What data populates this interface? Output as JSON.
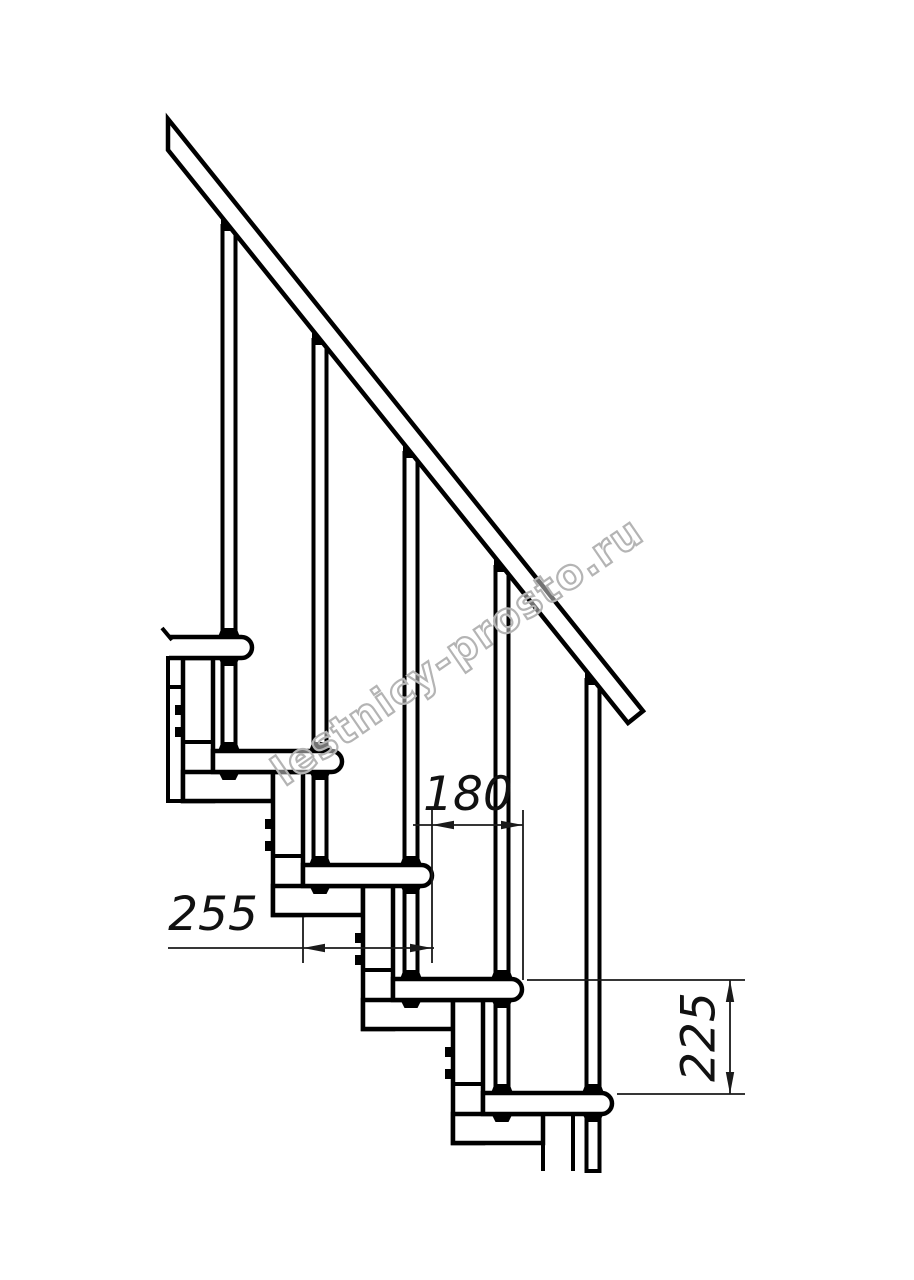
{
  "watermark": {
    "text": "lestnicy-prosto.ru",
    "color": "#b4b4b4"
  },
  "dimensions": {
    "run": {
      "label": "180"
    },
    "tread": {
      "label": "255"
    },
    "rise": {
      "label": "225"
    }
  },
  "colors": {
    "line": "#000000",
    "background": "#ffffff"
  }
}
